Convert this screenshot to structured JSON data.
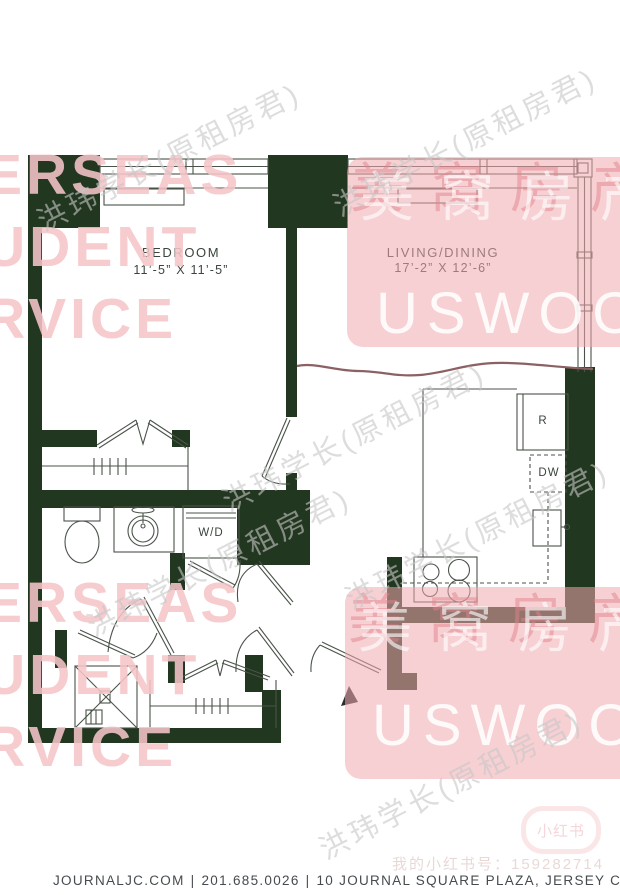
{
  "plan": {
    "rooms": {
      "bedroom": {
        "label": "BEDROOM",
        "dimensions": "11’-5” X 11’-5”"
      },
      "living_dining": {
        "label": "LIVING/DINING",
        "dimensions": "17’-2” X 12’-6”"
      }
    },
    "appliance_labels": {
      "refrigerator": "R",
      "dishwasher": "DW",
      "washer_dryer": "W/D"
    }
  },
  "watermarks": {
    "pink_text_lines": [
      "ERSEAS",
      "UDENT",
      "RVICE"
    ],
    "brand_overlay": {
      "cn": "美窝房产",
      "en": "USWOO"
    },
    "diagonal_text": "洪玮学长(原租房君)",
    "xiaohongshu": {
      "badge": "小红书",
      "id_line": "我的小红书号：159282714"
    }
  },
  "footer": {
    "website": "JOURNALJC.COM",
    "phone": "201.685.0026",
    "address": "10 JOURNAL SQUARE PLAZA, JERSEY CITY, NJ 07306",
    "divider": "|"
  },
  "colors": {
    "wall_fill": "#22371f",
    "plan_line": "#4a5349",
    "pink_overlay": "rgba(240,169,174,0.55)",
    "pink_text": "#f5c5c9",
    "wavy_line": "#8c6163",
    "footer_text": "#464b4f"
  }
}
